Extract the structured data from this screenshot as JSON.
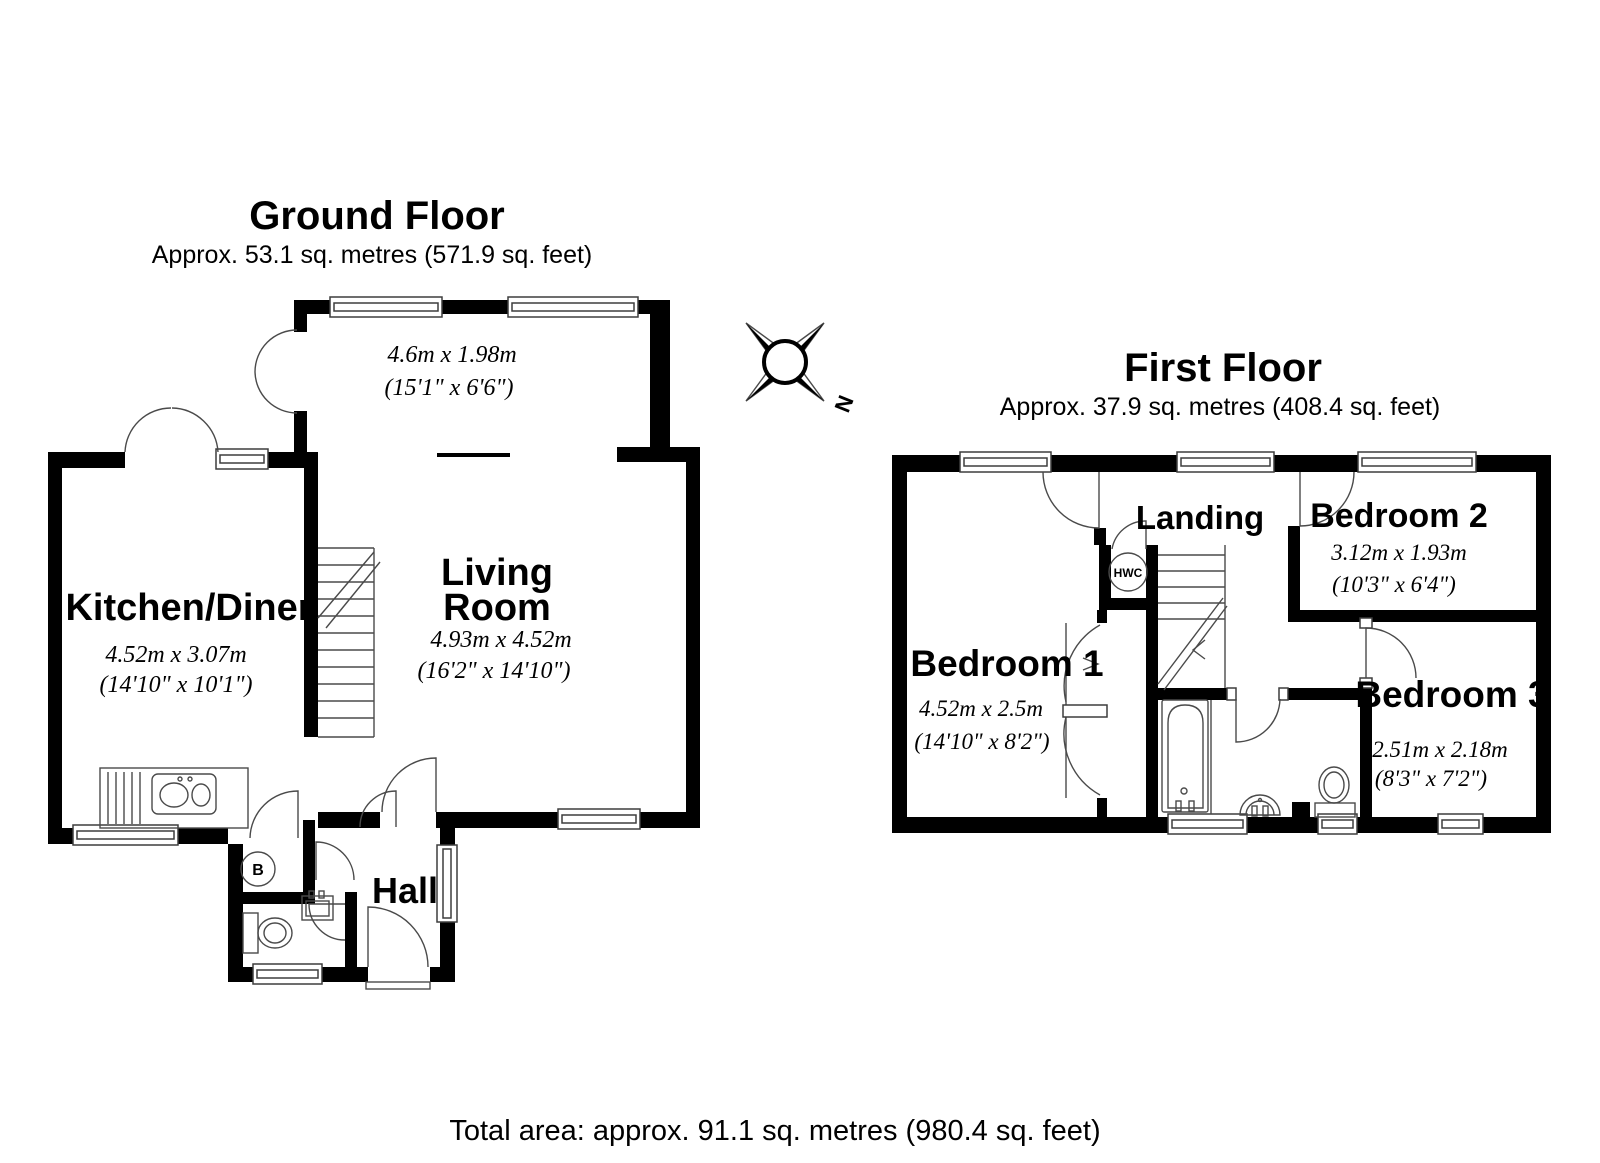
{
  "ground_floor": {
    "title": "Ground Floor",
    "area": "Approx. 53.1 sq. metres (571.9 sq. feet)",
    "rooms": {
      "extension": {
        "dim_m": "4.6m x 1.98m",
        "dim_ft": "(15'1\" x 6'6\")"
      },
      "kitchen_diner": {
        "name": "Kitchen/Diner",
        "dim_m": "4.52m x 3.07m",
        "dim_ft": "(14'10\" x 10'1\")"
      },
      "living_room": {
        "name_line1": "Living",
        "name_line2": "Room",
        "dim_m": "4.93m x 4.52m",
        "dim_ft": "(16'2\" x 14'10\")"
      },
      "hall": {
        "name": "Hall"
      },
      "boiler": {
        "label": "B"
      }
    }
  },
  "first_floor": {
    "title": "First Floor",
    "area": "Approx. 37.9 sq. metres (408.4 sq. feet)",
    "rooms": {
      "landing": {
        "name": "Landing"
      },
      "bedroom1": {
        "name": "Bedroom 1",
        "dim_m": "4.52m x 2.5m",
        "dim_ft": "(14'10\" x 8'2\")"
      },
      "bedroom2": {
        "name": "Bedroom 2",
        "dim_m": "3.12m x 1.93m",
        "dim_ft": "(10'3\" x 6'4\")"
      },
      "bedroom3": {
        "name": "Bedroom 3",
        "dim_m": "2.51m x 2.18m",
        "dim_ft": "(8'3\" x 7'2\")"
      },
      "hwc": {
        "label": "HWC"
      }
    }
  },
  "compass": {
    "north_label": "N"
  },
  "footer": {
    "total_area": "Total area: approx. 91.1 sq. metres (980.4 sq. feet)"
  },
  "colors": {
    "wall": "#000000",
    "line": "#4a4a4a",
    "background": "#ffffff"
  }
}
